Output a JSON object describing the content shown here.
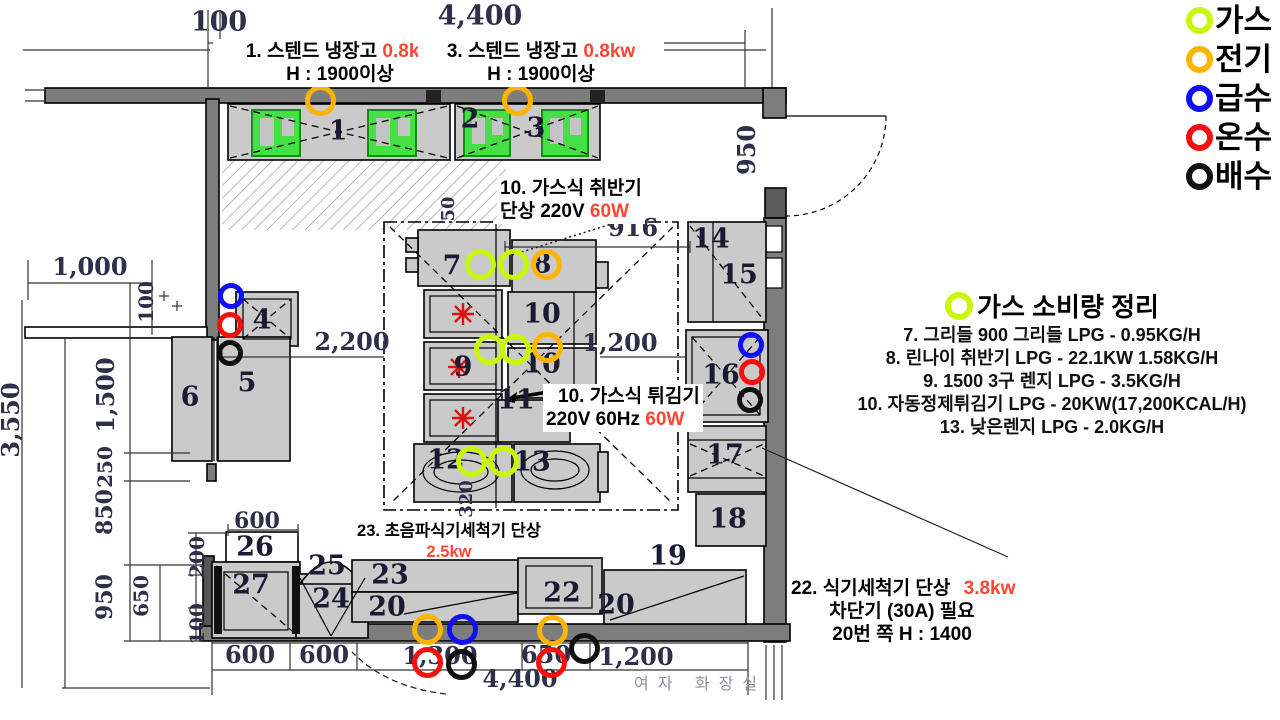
{
  "legend": {
    "items": [
      {
        "id": "gas",
        "label": "가스",
        "color": "#c8f70a"
      },
      {
        "id": "electric",
        "label": "전기",
        "color": "#ffb404"
      },
      {
        "id": "water",
        "label": "급수",
        "color": "#0f0ff5"
      },
      {
        "id": "hot",
        "label": "온수",
        "color": "#f50f0f"
      },
      {
        "id": "drain",
        "label": "배수",
        "color": "#101010"
      }
    ]
  },
  "marker_colors": {
    "gas": "#c8f70a",
    "electric": "#ffb404",
    "water": "#0f0ff5",
    "hot": "#f50f0f",
    "drain": "#101010"
  },
  "annotations": {
    "fridge1": {
      "text": "1. 스텐드 냉장고",
      "power": "0.8kw",
      "height": "H : 1900이상"
    },
    "fridge3": {
      "text": "3. 스텐드 냉장고",
      "power": "0.8kw",
      "height": "H : 1900이상"
    },
    "rice_cooker": {
      "line1": "10. 가스식 취반기",
      "line2": "단상 220V",
      "power": "60W"
    },
    "fryer": {
      "line1": "10. 가스식 튀김기",
      "line2": "220V 60Hz",
      "power": "60W"
    },
    "ultrasonic_washer": {
      "line1": "23. 초음파식기세척기 단상",
      "power": "2.5kw"
    },
    "dishwasher": {
      "line1": "22. 식기세척기 단상",
      "power": "3.8kw",
      "line2": "차단기 (30A) 필요",
      "line3": "20번 쪽 H : 1400"
    }
  },
  "gas_summary": {
    "title": "가스 소비량 정리",
    "lines": [
      "7. 그리들 900 그리들 LPG - 0.95KG/H",
      "8. 린나이 취반기 LPG - 22.1KW 1.58KG/H",
      "9. 1500 3구 렌지 LPG - 3.5KG/H",
      "10. 자동정제튀김기 LPG - 20KW(17,200KCAL/H)",
      "13. 낮은렌지 LPG - 2.0KG/H"
    ]
  },
  "room_label": "여자 화장실",
  "dimensions": [
    {
      "text": "100",
      "x": 219,
      "y": 22,
      "size": 27
    },
    {
      "text": "4,400",
      "x": 480,
      "y": 16,
      "size": 27
    },
    {
      "text": "950",
      "x": 747,
      "y": 150,
      "size": 24,
      "rot": true
    },
    {
      "text": "1,000",
      "x": 90,
      "y": 267,
      "size": 24
    },
    {
      "text": "100",
      "x": 146,
      "y": 302,
      "size": 20,
      "rot": true
    },
    {
      "text": "1,500",
      "x": 106,
      "y": 395,
      "size": 24,
      "rot": true
    },
    {
      "text": "3,550",
      "x": 11,
      "y": 420,
      "size": 24,
      "rot": true
    },
    {
      "text": "250",
      "x": 105,
      "y": 467,
      "size": 20,
      "rot": true
    },
    {
      "text": "850",
      "x": 105,
      "y": 512,
      "size": 22,
      "rot": true
    },
    {
      "text": "950",
      "x": 105,
      "y": 597,
      "size": 22,
      "rot": true
    },
    {
      "text": "650",
      "x": 141,
      "y": 596,
      "size": 20,
      "rot": true
    },
    {
      "text": "200",
      "x": 197,
      "y": 557,
      "size": 20,
      "rot": true
    },
    {
      "text": "100",
      "x": 197,
      "y": 624,
      "size": 20,
      "rot": true
    },
    {
      "text": "600",
      "x": 257,
      "y": 521,
      "size": 22
    },
    {
      "text": "2,200",
      "x": 352,
      "y": 342,
      "size": 24
    },
    {
      "text": "916",
      "x": 633,
      "y": 228,
      "size": 24
    },
    {
      "text": "1,200",
      "x": 620,
      "y": 343,
      "size": 24
    },
    {
      "text": "50",
      "x": 449,
      "y": 209,
      "size": 18,
      "rot": true
    },
    {
      "text": "320",
      "x": 467,
      "y": 499,
      "size": 18,
      "rot": true
    },
    {
      "text": "600",
      "x": 250,
      "y": 655,
      "size": 24
    },
    {
      "text": "600",
      "x": 324,
      "y": 655,
      "size": 24
    },
    {
      "text": "1,300",
      "x": 440,
      "y": 656,
      "size": 24
    },
    {
      "text": "650",
      "x": 546,
      "y": 655,
      "size": 24
    },
    {
      "text": "1,200",
      "x": 636,
      "y": 657,
      "size": 24
    },
    {
      "text": "4,400",
      "x": 520,
      "y": 679,
      "size": 24
    }
  ],
  "unit_numbers": [
    {
      "n": "1",
      "x": 338,
      "y": 131
    },
    {
      "n": "2",
      "x": 470,
      "y": 119
    },
    {
      "n": "3",
      "x": 536,
      "y": 128
    },
    {
      "n": "4",
      "x": 262,
      "y": 320
    },
    {
      "n": "5",
      "x": 247,
      "y": 383
    },
    {
      "n": "6",
      "x": 190,
      "y": 397
    },
    {
      "n": "7",
      "x": 452,
      "y": 266
    },
    {
      "n": "8",
      "x": 542,
      "y": 264
    },
    {
      "n": "9",
      "x": 463,
      "y": 367
    },
    {
      "n": "10",
      "x": 542,
      "y": 314
    },
    {
      "n": "10",
      "x": 542,
      "y": 364
    },
    {
      "n": "11",
      "x": 516,
      "y": 400
    },
    {
      "n": "12",
      "x": 446,
      "y": 460
    },
    {
      "n": "13",
      "x": 532,
      "y": 462
    },
    {
      "n": "14",
      "x": 711,
      "y": 239
    },
    {
      "n": "15",
      "x": 739,
      "y": 275
    },
    {
      "n": "16",
      "x": 721,
      "y": 375
    },
    {
      "n": "17",
      "x": 725,
      "y": 455
    },
    {
      "n": "18",
      "x": 728,
      "y": 519
    },
    {
      "n": "19",
      "x": 668,
      "y": 556
    },
    {
      "n": "20",
      "x": 387,
      "y": 607
    },
    {
      "n": "20",
      "x": 616,
      "y": 605
    },
    {
      "n": "22",
      "x": 562,
      "y": 593
    },
    {
      "n": "23",
      "x": 390,
      "y": 575
    },
    {
      "n": "24",
      "x": 331,
      "y": 599
    },
    {
      "n": "25",
      "x": 327,
      "y": 566
    },
    {
      "n": "26",
      "x": 255,
      "y": 547
    },
    {
      "n": "27",
      "x": 251,
      "y": 585
    }
  ],
  "markers": [
    {
      "type": "electric",
      "x": 320,
      "y": 100
    },
    {
      "type": "electric",
      "x": 517,
      "y": 100
    },
    {
      "type": "gas",
      "x": 480,
      "y": 264
    },
    {
      "type": "gas",
      "x": 513,
      "y": 264
    },
    {
      "type": "electric",
      "x": 546,
      "y": 264
    },
    {
      "type": "gas",
      "x": 489,
      "y": 349
    },
    {
      "type": "gas",
      "x": 515,
      "y": 349
    },
    {
      "type": "electric",
      "x": 547,
      "y": 347
    },
    {
      "type": "gas",
      "x": 471,
      "y": 461
    },
    {
      "type": "gas",
      "x": 503,
      "y": 461
    },
    {
      "type": "water",
      "x": 231,
      "y": 296,
      "r": 13
    },
    {
      "type": "hot",
      "x": 230,
      "y": 325,
      "r": 13
    },
    {
      "type": "drain",
      "x": 230,
      "y": 353,
      "r": 13
    },
    {
      "type": "water",
      "x": 751,
      "y": 345,
      "r": 13
    },
    {
      "type": "hot",
      "x": 752,
      "y": 372,
      "r": 13
    },
    {
      "type": "drain",
      "x": 750,
      "y": 400,
      "r": 13
    },
    {
      "type": "electric",
      "x": 427,
      "y": 629
    },
    {
      "type": "water",
      "x": 462,
      "y": 629
    },
    {
      "type": "hot",
      "x": 427,
      "y": 662
    },
    {
      "type": "drain",
      "x": 461,
      "y": 664
    },
    {
      "type": "electric",
      "x": 552,
      "y": 630
    },
    {
      "type": "hot",
      "x": 551,
      "y": 662
    },
    {
      "type": "drain",
      "x": 584,
      "y": 648
    }
  ]
}
